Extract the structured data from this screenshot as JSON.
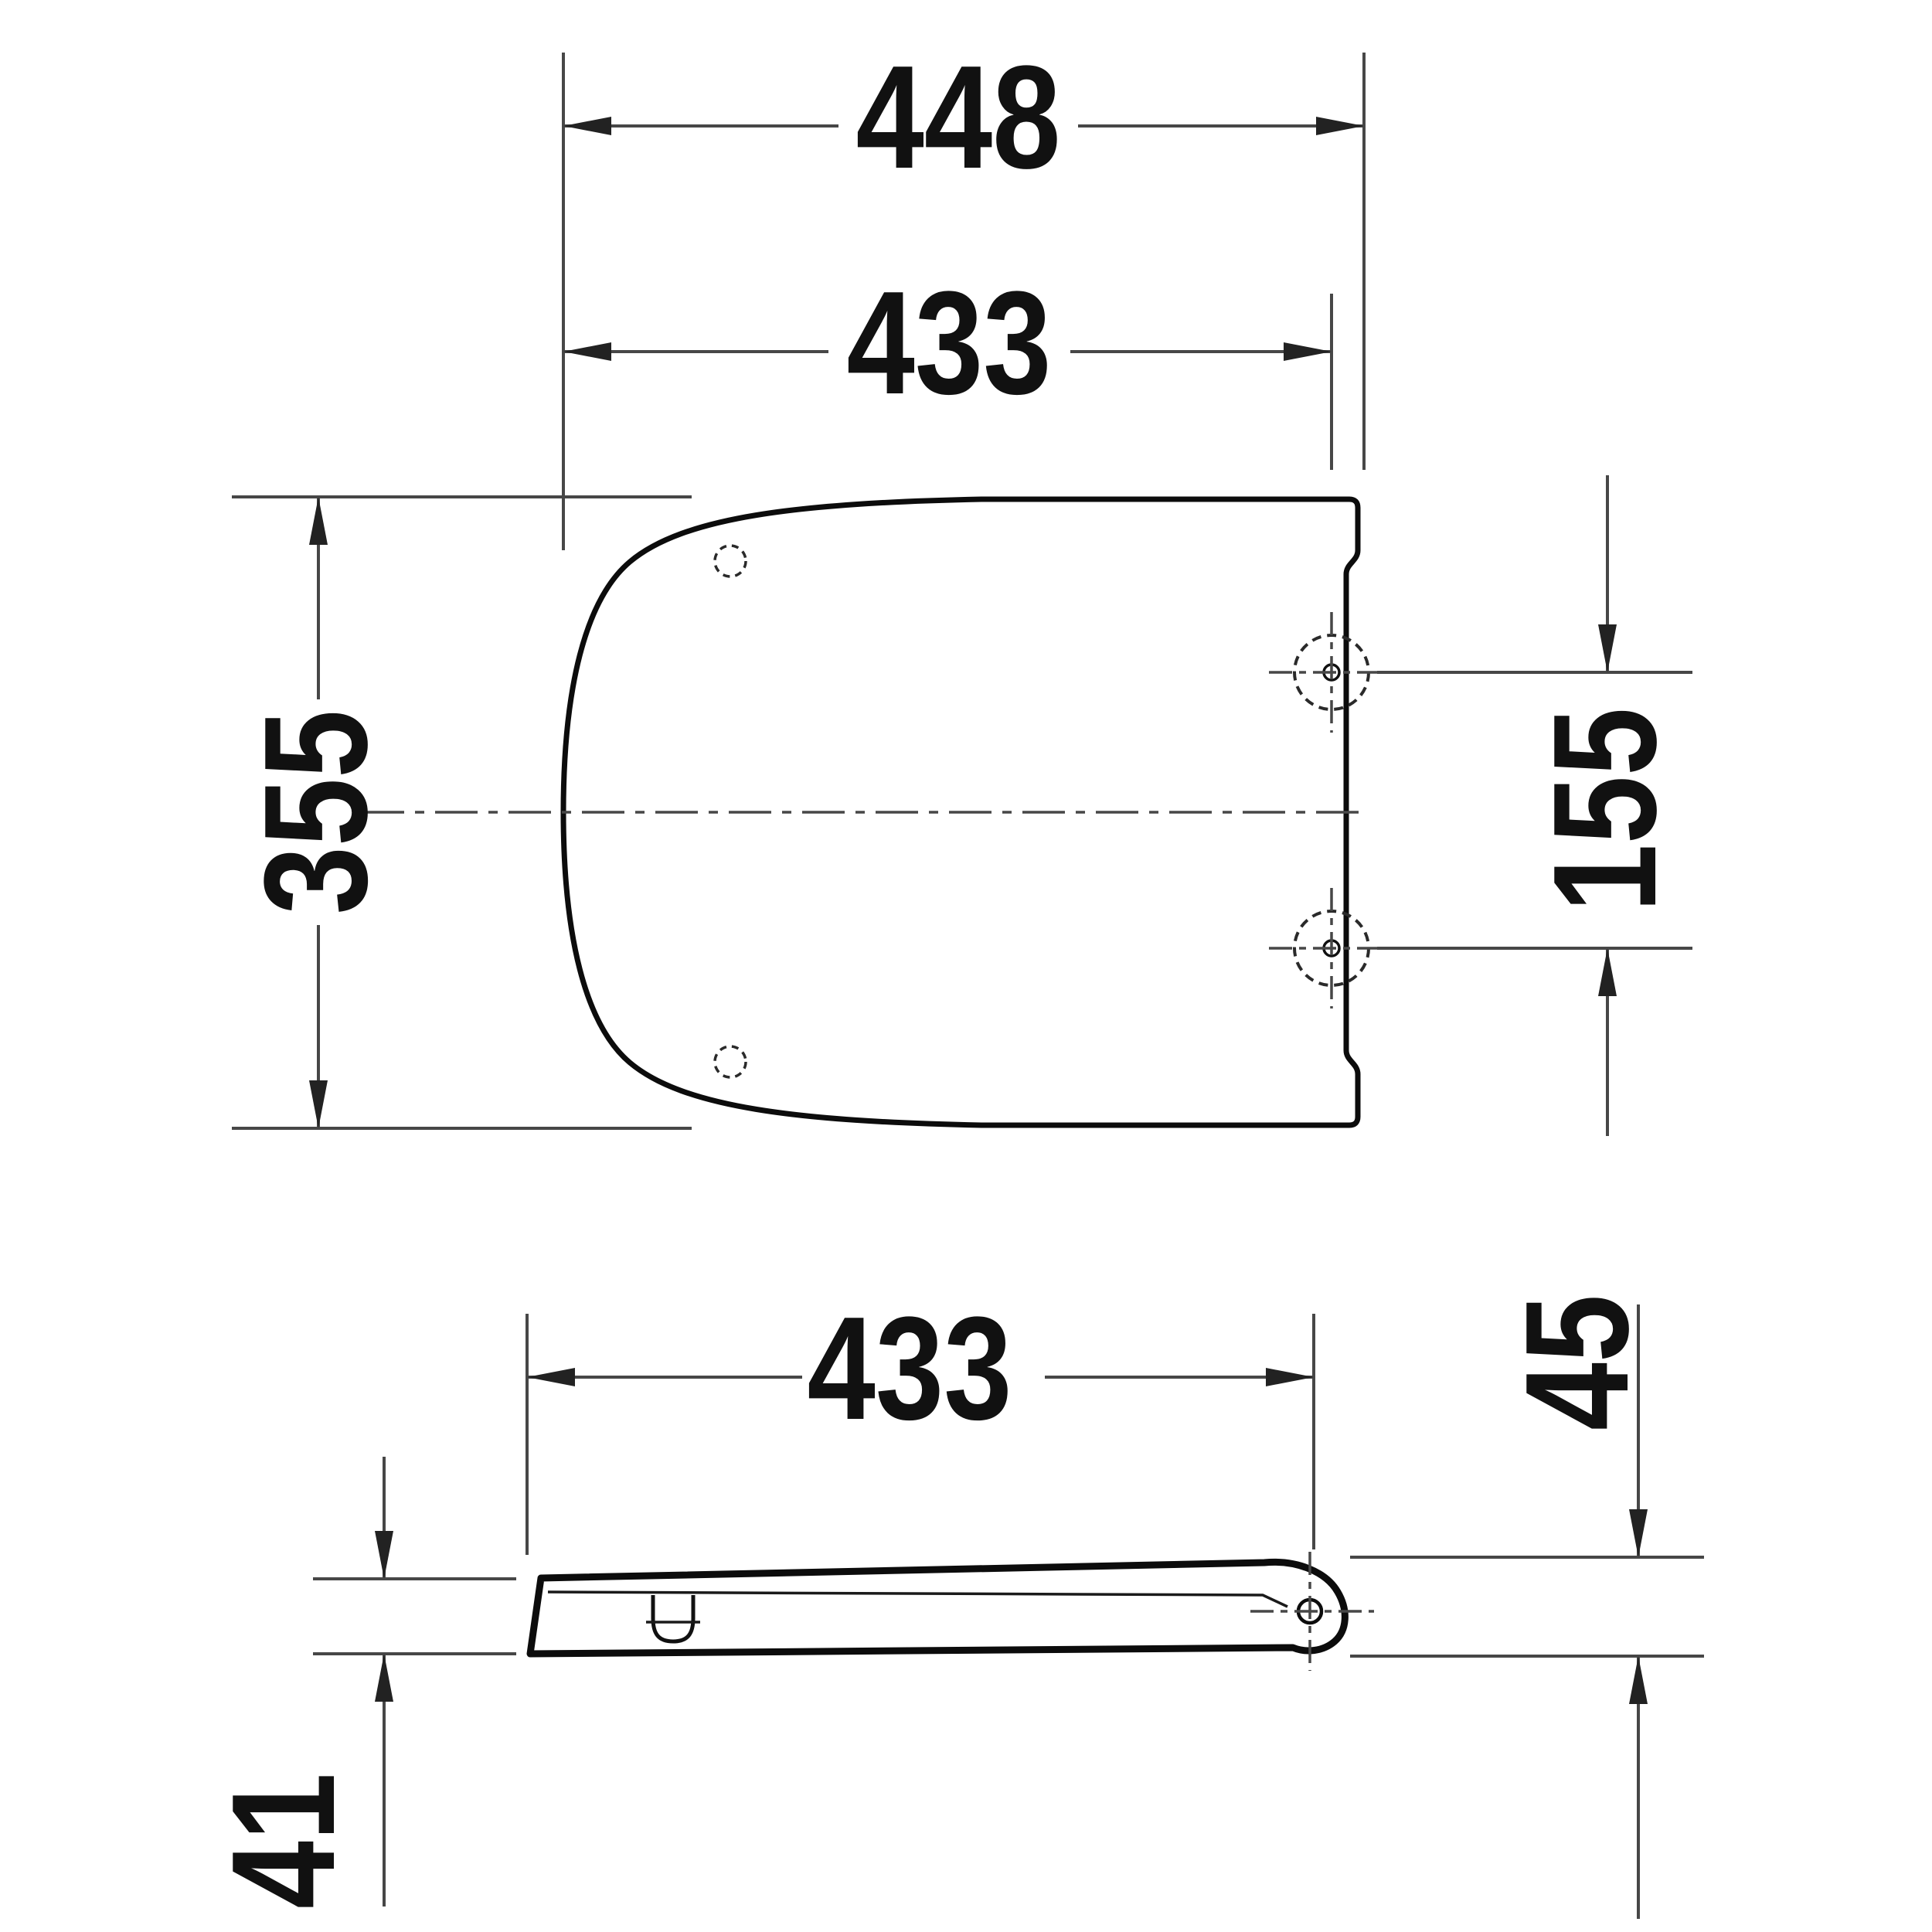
{
  "drawing": {
    "colors": {
      "background": "#ffffff",
      "dimension_lines": "#474747",
      "object_outline": "#0c0c0c",
      "text_ink": "#111111"
    },
    "top_view": {
      "overall_length": "448",
      "front_to_hinge_holes": "433",
      "overall_width": "355",
      "hinge_hole_spacing": "155"
    },
    "side_view": {
      "length_to_hinge": "433",
      "rear_height": "45",
      "front_height": "41"
    }
  }
}
